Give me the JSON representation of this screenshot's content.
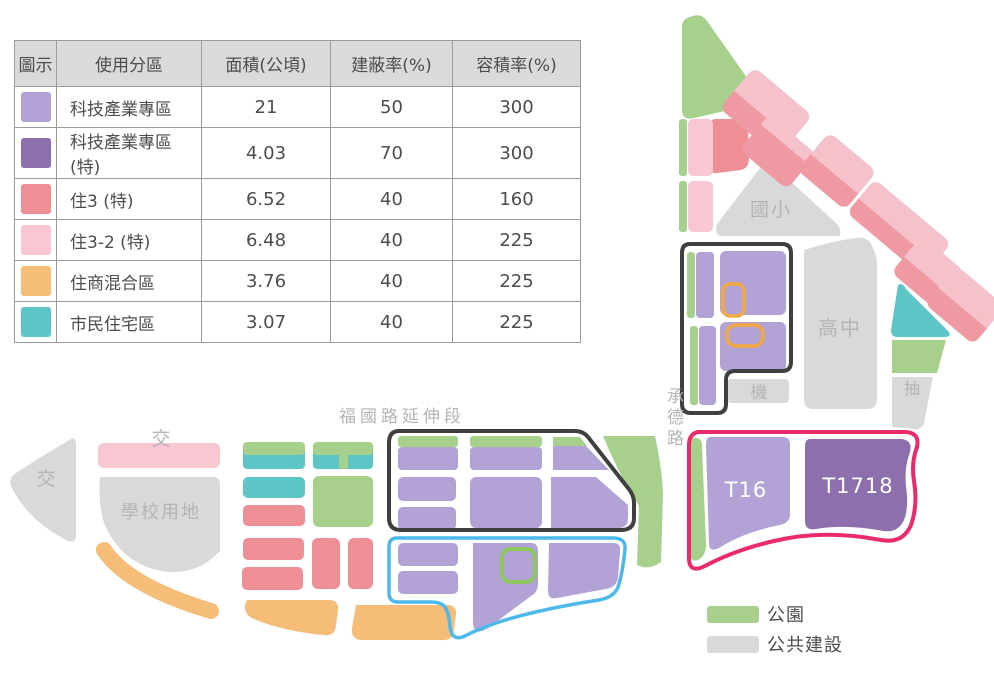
{
  "table": {
    "headers": [
      "圖示",
      "使用分區",
      "面積(公頃)",
      "建蔽率(%)",
      "容積率(%)"
    ],
    "rows": [
      {
        "swatch_color": "#b3a2d6",
        "zone": "科技產業專區",
        "area": "21",
        "coverage_ratio": "50",
        "floor_area_ratio": "300"
      },
      {
        "swatch_color": "#8d6fad",
        "zone": "科技產業專區(特)",
        "area": "4.03",
        "coverage_ratio": "70",
        "floor_area_ratio": "300"
      },
      {
        "swatch_color": "#ee8e95",
        "zone": "住3 (特)",
        "area": "6.52",
        "coverage_ratio": "40",
        "floor_area_ratio": "160"
      },
      {
        "swatch_color": "#f8c7d2",
        "zone": "住3-2 (特)",
        "area": "6.48",
        "coverage_ratio": "40",
        "floor_area_ratio": "225"
      },
      {
        "swatch_color": "#f6bd79",
        "zone": "住商混合區",
        "area": "3.76",
        "coverage_ratio": "40",
        "floor_area_ratio": "225"
      },
      {
        "swatch_color": "#5ec5c6",
        "zone": "市民住宅區",
        "area": "3.07",
        "coverage_ratio": "40",
        "floor_area_ratio": "225"
      }
    ]
  },
  "map": {
    "labels": {
      "fuguo_road": "福國路延伸段",
      "chengde_road": "承德路",
      "elementary_school": "國小",
      "high_school": "高中",
      "machine": "機",
      "pump": "抽",
      "school_land": "學校用地",
      "intersection_left": "交",
      "intersection_top": "交",
      "t16": "T16",
      "t1718": "T1718"
    },
    "legend": {
      "park": "公園",
      "public_construction": "公共建設"
    }
  },
  "colors": {
    "purple": "#b3a2d6",
    "purple_dark": "#8d6fad",
    "red": "#ee8e95",
    "pink": "#f8c7d2",
    "orange": "#f6bd79",
    "teal": "#5ec5c6",
    "green": "#a6d08b",
    "gray": "#d8d9da",
    "diag_pink": "#f5c2cc",
    "diag_red": "#ef9aa2",
    "outline_black": "#3f3f3f",
    "outline_blue": "#4cb9ea",
    "outline_pink": "#e92a6d",
    "outline_orange": "#f2a940",
    "outline_green": "#8fc75c",
    "label_gray": "#b3b4b6",
    "text_dark": "#4d4d4d",
    "white": "#ffffff"
  }
}
